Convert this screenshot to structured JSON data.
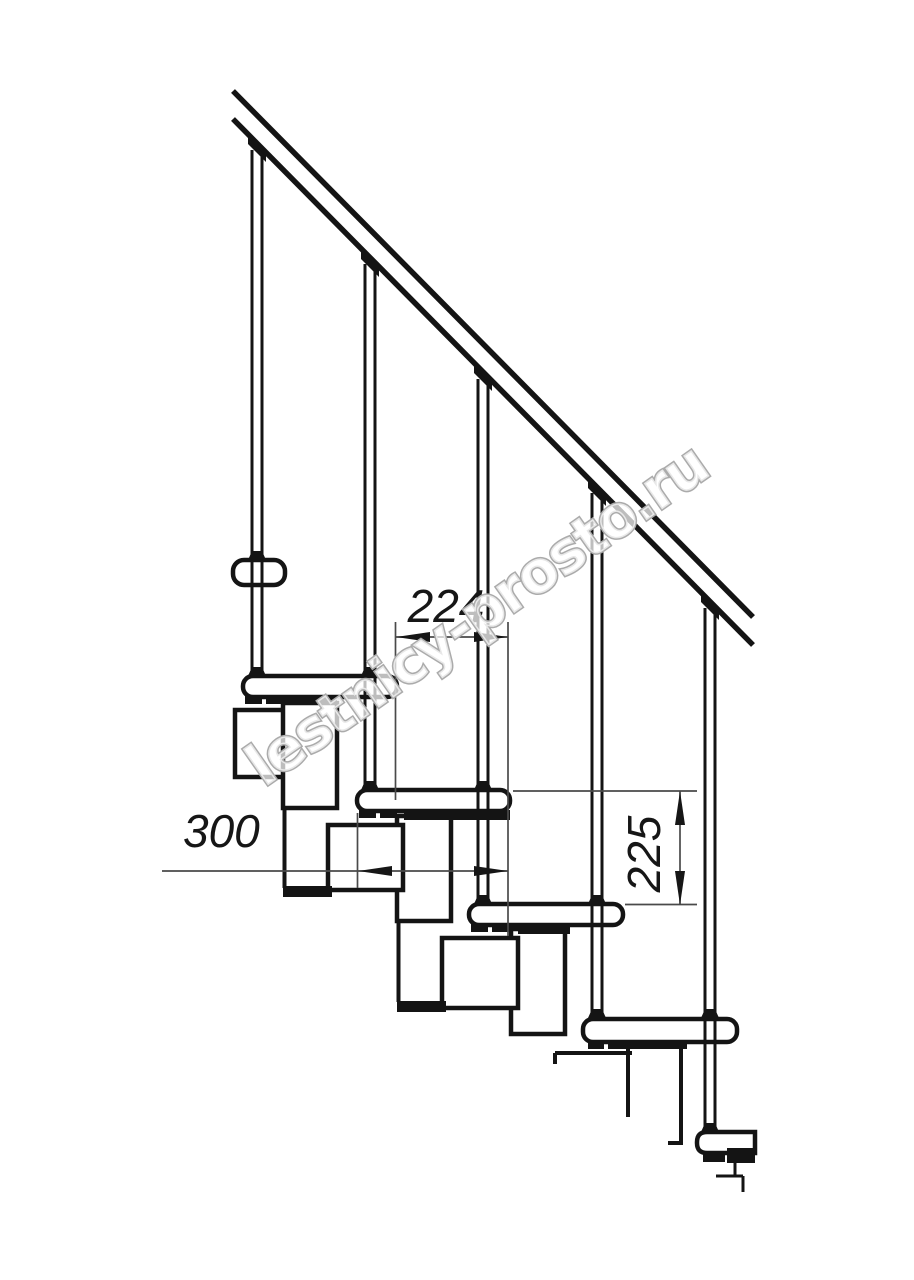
{
  "page": {
    "background": "#ffffff",
    "description_text": "Side view technical drawing of a modular staircase section with handrail, balusters, treads and support modules"
  },
  "watermark": {
    "text": "lestnicy-prosto.ru",
    "x": 264,
    "y": 788,
    "rotate": -35,
    "font_size": 58,
    "letter_spacing": -2,
    "fill": "rgba(255,255,255,0.72)",
    "stroke": "#ababab",
    "stroke_width": 3
  },
  "dim_style": {
    "line_color": "#4a4a4a",
    "line_width": 1.7,
    "arrow_color": "#161616",
    "text_color": "#161616",
    "font_size": 46,
    "arrow_len": 34,
    "arrow_half_h": 5
  },
  "dimensions": [
    {
      "id": "dim-step-run-224",
      "label": "224",
      "line": [
        396,
        637,
        508,
        637
      ],
      "arrows": [
        {
          "tip": [
            396,
            637
          ],
          "dir": "left"
        },
        {
          "tip": [
            508,
            637
          ],
          "dir": "right"
        }
      ],
      "ext": [
        [
          395.5,
          622,
          395.5,
          800
        ],
        [
          508,
          622,
          508,
          936
        ]
      ],
      "text": {
        "x": 446,
        "y": 622,
        "anchor": "middle",
        "rotate": 0
      }
    },
    {
      "id": "dim-tread-depth-300",
      "label": "300",
      "line": [
        162,
        871,
        508,
        871
      ],
      "arrows": [
        {
          "tip": [
            358,
            871
          ],
          "dir": "left"
        },
        {
          "tip": [
            508,
            871
          ],
          "dir": "right"
        }
      ],
      "ext": [
        [
          357.5,
          813,
          357.5,
          888
        ]
      ],
      "text": {
        "x": 183,
        "y": 847,
        "anchor": "start",
        "rotate": 0
      }
    },
    {
      "id": "dim-step-rise-225",
      "label": "225",
      "line": [
        680,
        791,
        680,
        905
      ],
      "arrows": [
        {
          "tip": [
            680,
            791
          ],
          "dir": "up"
        },
        {
          "tip": [
            680,
            905
          ],
          "dir": "down"
        }
      ],
      "ext": [
        [
          513,
          791,
          697,
          791
        ],
        [
          625,
          904.5,
          697,
          904.5
        ]
      ],
      "text": {
        "x": 660,
        "y": 854,
        "anchor": "middle",
        "rotate": -90
      }
    }
  ],
  "drawing": {
    "canvas": {
      "w": 914,
      "h": 1280
    },
    "stroke_main": "#141414",
    "fill_main": "#ffffff",
    "rail": {
      "width": 5.5,
      "lines": [
        [
          233,
          91,
          753,
          617
        ],
        [
          233,
          119,
          753,
          645
        ]
      ]
    },
    "balusters": [
      {
        "id": "baluster-1",
        "cx": 257,
        "y_top": 150,
        "y_bottom": 676,
        "connector_y": 143,
        "collars": [
          560,
          676
        ]
      },
      {
        "id": "baluster-2",
        "cx": 370,
        "y_top": 264,
        "y_bottom": 790,
        "connector_y": 258,
        "collars": [
          676,
          790
        ]
      },
      {
        "id": "baluster-3",
        "cx": 483,
        "y_top": 379,
        "y_bottom": 904,
        "connector_y": 372,
        "collars": [
          790,
          904
        ]
      },
      {
        "id": "baluster-4",
        "cx": 597,
        "y_top": 493,
        "y_bottom": 1018,
        "connector_y": 487,
        "collars": [
          904,
          1018
        ]
      },
      {
        "id": "baluster-5",
        "cx": 710,
        "y_top": 608,
        "y_bottom": 1132,
        "connector_y": 601,
        "collars": [
          1018,
          1132
        ]
      }
    ],
    "treads": [
      {
        "id": "tread-1-fragment",
        "x": 233,
        "y": 560,
        "w": 52,
        "h": 25,
        "r": 11,
        "cut": "none"
      },
      {
        "id": "tread-2",
        "x": 243,
        "y": 676,
        "w": 154,
        "h": 21,
        "r": 10,
        "cut": "none"
      },
      {
        "id": "tread-3",
        "x": 357,
        "y": 790,
        "w": 153,
        "h": 21,
        "r": 10,
        "cut": "none"
      },
      {
        "id": "tread-4",
        "x": 469,
        "y": 904,
        "w": 154,
        "h": 21,
        "r": 10,
        "cut": "none"
      },
      {
        "id": "tread-5",
        "x": 583,
        "y": 1019,
        "w": 154,
        "h": 23,
        "r": 10,
        "cut": "none"
      },
      {
        "id": "tread-6-fragment",
        "x": 697,
        "y": 1132,
        "w": 58,
        "h": 21,
        "r": 10,
        "cut": "right"
      }
    ],
    "modules": [
      {
        "id": "module-1-horizontal-fragment",
        "x": 235,
        "y": 710,
        "w": 53,
        "h": 67
      },
      {
        "id": "module-2-vertical",
        "x": 283,
        "y": 703,
        "w": 54,
        "h": 105
      },
      {
        "id": "module-3-vertical",
        "x": 397,
        "y": 816,
        "w": 54,
        "h": 105
      },
      {
        "id": "module-3-horizontal",
        "x": 328,
        "y": 825,
        "w": 75,
        "h": 65
      },
      {
        "id": "module-4-vertical",
        "x": 511,
        "y": 929,
        "w": 54,
        "h": 105
      },
      {
        "id": "module-4-horizontal",
        "x": 442,
        "y": 938,
        "w": 76,
        "h": 70
      }
    ],
    "connector_lines": [
      [
        284.5,
        777,
        284.5,
        888
      ],
      [
        398.5,
        921,
        398.5,
        1002
      ],
      [
        555,
        1053,
        632,
        1053
      ],
      [
        555,
        1053,
        555,
        1064
      ],
      [
        628,
        1042,
        628,
        1117
      ],
      [
        681,
        1043,
        681,
        1145
      ],
      [
        668,
        1143,
        681,
        1143
      ]
    ],
    "floor_step_lines": [
      [
        735,
        1163,
        735,
        1176
      ],
      [
        716,
        1176,
        743,
        1176
      ],
      [
        743,
        1176,
        743,
        1192
      ]
    ],
    "black_marks": [
      [
        245,
        695,
        17,
        9
      ],
      [
        266,
        695,
        17,
        9
      ],
      [
        281,
        695,
        56,
        9
      ],
      [
        359,
        809,
        17,
        9
      ],
      [
        380,
        809,
        17,
        9
      ],
      [
        404,
        810,
        106,
        10
      ],
      [
        471,
        923,
        17,
        9
      ],
      [
        492,
        923,
        17,
        9
      ],
      [
        518,
        925,
        52,
        9
      ],
      [
        588,
        1040,
        16,
        9
      ],
      [
        608,
        1040,
        16,
        9
      ],
      [
        615,
        1040,
        72,
        9
      ],
      [
        703,
        1151,
        22,
        11
      ],
      [
        727,
        1148,
        28,
        15
      ],
      [
        283,
        886,
        49,
        11
      ],
      [
        397,
        1001,
        49,
        11
      ]
    ]
  }
}
